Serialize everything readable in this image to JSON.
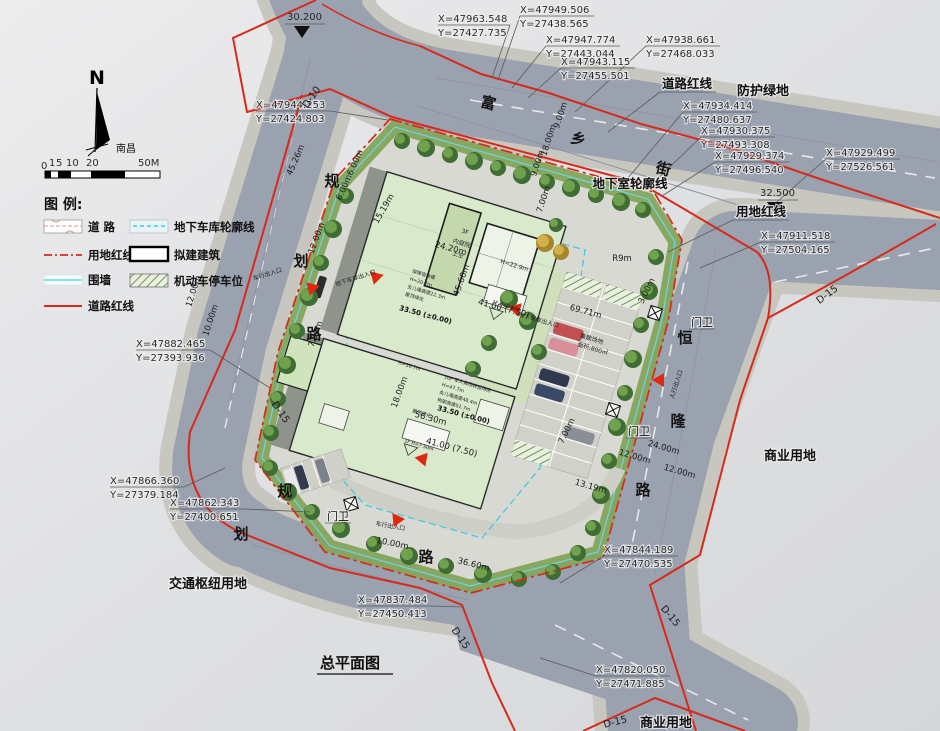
{
  "title": "总平面图",
  "compass": {
    "n": "N",
    "city": "南昌"
  },
  "scalebar": {
    "ticks": [
      "0",
      "1",
      "5",
      "10",
      "20",
      "50M"
    ]
  },
  "legend": {
    "title": "图 例:",
    "items": [
      {
        "name": "road",
        "label": "道  路"
      },
      {
        "name": "site-red-line",
        "label": "用地红线"
      },
      {
        "name": "fence",
        "label": "围墙"
      },
      {
        "name": "road-red-line",
        "label": "道路红线"
      },
      {
        "name": "garage-outline",
        "label": "地下车库轮廓线"
      },
      {
        "name": "proposed-building",
        "label": "拟建建筑"
      },
      {
        "name": "parking-space",
        "label": "机动车停车位"
      }
    ]
  },
  "colors": {
    "red_line": "#d8291a",
    "fence_cyan": "#6fd4e4",
    "road": "#9aa1af",
    "building_green": "#d9e9cc"
  },
  "callouts": [
    {
      "x": "X=47963.548",
      "y": "Y=27427.735"
    },
    {
      "x": "X=47949.506",
      "y": "Y=27438.565"
    },
    {
      "x": "X=47947.774",
      "y": "Y=27443.044"
    },
    {
      "x": "X=47943.115",
      "y": "Y=27455.501"
    },
    {
      "x": "X=47938.661",
      "y": "Y=27468.033"
    },
    {
      "x": "X=47944.253",
      "y": "Y=27424.803"
    },
    {
      "x": "X=47934.414",
      "y": "Y=27480.637"
    },
    {
      "x": "X=47930.375",
      "y": "Y=27493.308"
    },
    {
      "x": "X=47929.374",
      "y": "Y=27496.540"
    },
    {
      "x": "X=47929.499",
      "y": "Y=27526.561"
    },
    {
      "x": "X=47911.518",
      "y": "Y=27504.165"
    },
    {
      "x": "X=47882.465",
      "y": "Y=27393.936"
    },
    {
      "x": "X=47866.360",
      "y": "Y=27379.184"
    },
    {
      "x": "X=47862.343",
      "y": "Y=27400.651"
    },
    {
      "x": "X=47844.189",
      "y": "Y=27470.535"
    },
    {
      "x": "X=47837.484",
      "y": "Y=27450.413"
    },
    {
      "x": "X=47820.050",
      "y": "Y=27471.885"
    }
  ],
  "elevations": [
    "30.200",
    "32.500"
  ],
  "codes": [
    "D-10",
    "D-15",
    "D-15",
    "D-15",
    "D-15",
    "D-15"
  ],
  "streets": {
    "fuxiang": [
      "富",
      "乡",
      "街"
    ],
    "guihua1": [
      "规",
      "划",
      "路"
    ],
    "guihua2": [
      "规",
      "划",
      "路"
    ],
    "henglong": [
      "恒",
      "隆",
      "路"
    ]
  },
  "areas": [
    "防护绿地",
    "商业用地",
    "商业用地",
    "交通枢纽用地"
  ],
  "line_labels": [
    "道路红线",
    "用地红线",
    "地下室轮廓线"
  ],
  "guards": [
    "门卫",
    "门卫",
    "门卫"
  ],
  "dims": [
    {
      "t": "9.00m"
    },
    {
      "t": "18.00m"
    },
    {
      "t": "9.00m"
    },
    {
      "t": "7.00m"
    },
    {
      "t": "45.26m"
    },
    {
      "t": "6.00m6.00m"
    },
    {
      "t": "15.19m"
    },
    {
      "t": "12.00m"
    },
    {
      "t": "12.00m"
    },
    {
      "t": "10.00m"
    },
    {
      "t": "7.00m"
    },
    {
      "t": "10.00m"
    },
    {
      "t": "36.60m"
    },
    {
      "t": "3.00m"
    },
    {
      "t": "R9m"
    },
    {
      "t": "12.00m"
    },
    {
      "t": "24.00m"
    },
    {
      "t": "12.00m"
    },
    {
      "t": "7.00m"
    },
    {
      "t": "13.19m"
    },
    {
      "t": "18.00m"
    },
    {
      "t": "24.20m"
    },
    {
      "t": "45.60m"
    },
    {
      "t": "56.30m"
    },
    {
      "t": "69.71m"
    },
    {
      "t": "41.00 (7.50)"
    },
    {
      "t": "41.00 (7.50)"
    },
    {
      "t": "33.50 (±0.00)"
    },
    {
      "t": "33.50 (±0.00)"
    }
  ],
  "entrances": [
    "车行出入口",
    "地下车库出入口",
    "地下车库出入口",
    "人行出入口",
    "车行出入口"
  ],
  "building": {
    "blockA": [
      "保障宿舍楼",
      "H=20.7m",
      "女儿墙高度22.3m",
      "屋顶绿化"
    ],
    "blockB": [
      "10F 军人候场转运用房",
      "H=47.7m",
      "女儿墙高度48.4m",
      "构架高度51.7m"
    ],
    "roof_green": "屋顶绿化",
    "courtyard": [
      "3F",
      "内庭院",
      "上空"
    ],
    "h229": "H=22.9m",
    "h507": "H=50.7m",
    "f1a": "1F H=7.50m",
    "f1b": "1F H=7.50m",
    "assembly": [
      "集散场地",
      "面积:800㎡"
    ]
  }
}
